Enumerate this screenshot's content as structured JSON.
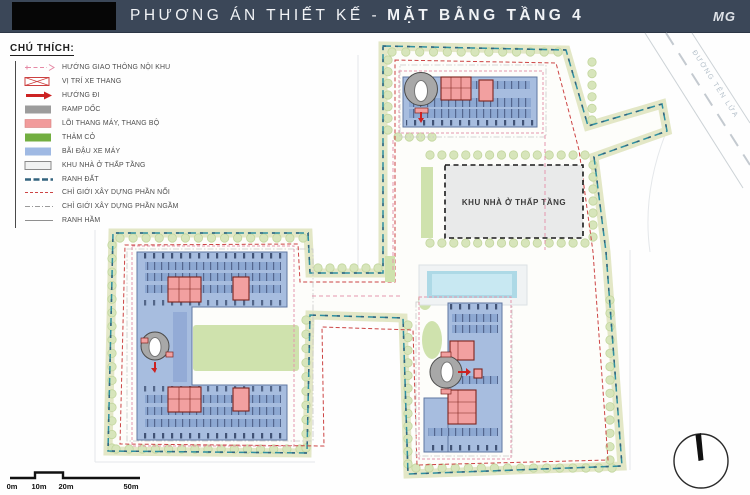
{
  "title_bar": {
    "title_regular": "PHƯƠNG ÁN THIẾT KẾ -",
    "title_bold": "MẶT BẰNG TẦNG 4",
    "brand_logo": "MG"
  },
  "legend": {
    "heading": "CHÚ THÍCH:",
    "items": [
      {
        "label": "HƯỚNG GIAO THÔNG NỘI KHU",
        "symbol": "pink-dashed-arrow-line"
      },
      {
        "label": "VỊ TRÍ XE THANG",
        "symbol": "red-crossed-box"
      },
      {
        "label": "HƯỚNG ĐI",
        "symbol": "red-arrow"
      },
      {
        "label": "RAMP DỐC",
        "symbol": "gray-fill"
      },
      {
        "label": "LÕI THANG MÁY, THANG BỘ",
        "symbol": "pink-fill"
      },
      {
        "label": "THẢM CỎ",
        "symbol": "green-fill"
      },
      {
        "label": "BÃI ĐẬU XE MÁY",
        "symbol": "blue-fill"
      },
      {
        "label": "KHU NHÀ Ở THẤP TẦNG",
        "symbol": "lightgray-outline-box"
      },
      {
        "label": "RANH ĐẤT",
        "symbol": "teal-dashed-line"
      },
      {
        "label": "CHỈ GIỚI XÂY DỰNG PHẦN NỔI",
        "symbol": "red-dashed-line"
      },
      {
        "label": "CHỈ GIỚI XÂY DỰNG PHẦN NGẦM",
        "symbol": "gray-dashdot-line"
      },
      {
        "label": "RANH HẦM",
        "symbol": "gray-solid-line"
      }
    ]
  },
  "plan": {
    "low_rise_label": "KHU NHÀ Ở THẤP TẦNG",
    "street_label": "ĐƯỜNG TÊN LỬA"
  },
  "scale_bar": {
    "labels": [
      "0m",
      "10m",
      "20m",
      "50m"
    ]
  },
  "colors": {
    "title_bar_bg": "#3b4758",
    "boundary_teal": "#2e8fa0",
    "boundary_navy": "#33647f",
    "construction_red": "#cc4444",
    "building_blue": "#a7bddf",
    "parking_stripe_blue": "#8da8d2",
    "core_pink": "#f2a0a0",
    "lawn_green": "#cfe2ad",
    "band_olive": "#e3e7c6",
    "low_rise_gray": "#e9eaea",
    "pool_blue": "#add9e6",
    "circulation_pink": "#e596ad",
    "ramp_gray": "#a8a8a8"
  }
}
